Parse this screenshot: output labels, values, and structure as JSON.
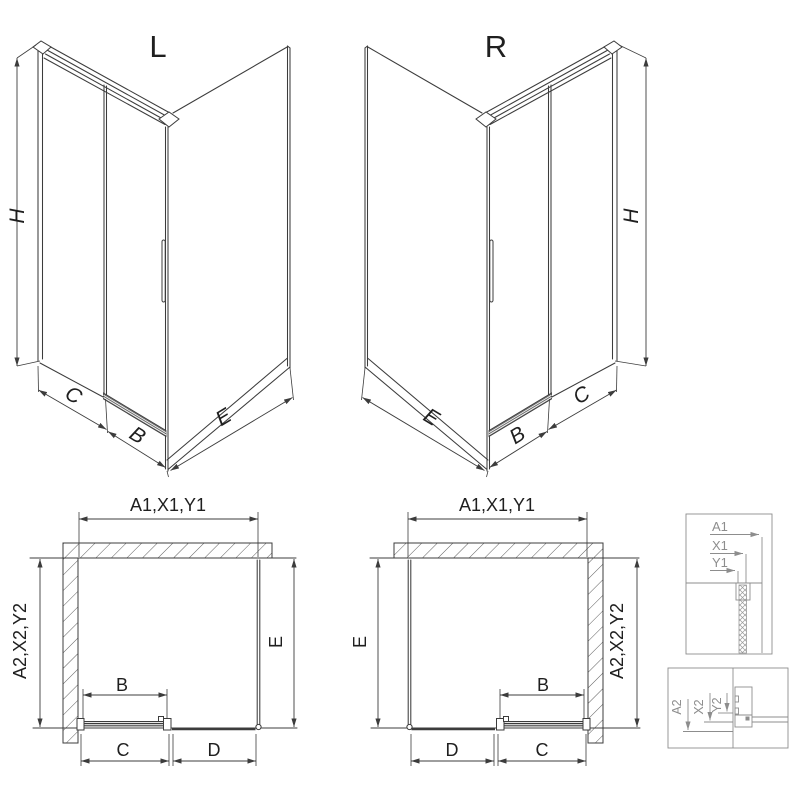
{
  "colors": {
    "line": "#3c3c3c",
    "detail_gray": "#8d8d8d",
    "text": "#1f1f1f",
    "background": "#ffffff"
  },
  "iso_left": {
    "label": "L",
    "dim_h": "H",
    "dim_c": "C",
    "dim_b": "B",
    "dim_e": "E"
  },
  "iso_right": {
    "label": "R",
    "dim_h": "H",
    "dim_c": "C",
    "dim_b": "B",
    "dim_e": "E"
  },
  "plan_left": {
    "dim_top": "A1,X1,Y1",
    "dim_left": "A2,X2,Y2",
    "dim_right": "E",
    "dim_b": "B",
    "dim_c": "C",
    "dim_d": "D"
  },
  "plan_right": {
    "dim_top": "A1,X1,Y1",
    "dim_left": "E",
    "dim_right": "A2,X2,Y2",
    "dim_b": "B",
    "dim_c": "C",
    "dim_d": "D"
  },
  "detail_top": {
    "labels": [
      "A1",
      "X1",
      "Y1"
    ]
  },
  "detail_bottom": {
    "labels": [
      "A2",
      "X2",
      "Y2"
    ]
  }
}
